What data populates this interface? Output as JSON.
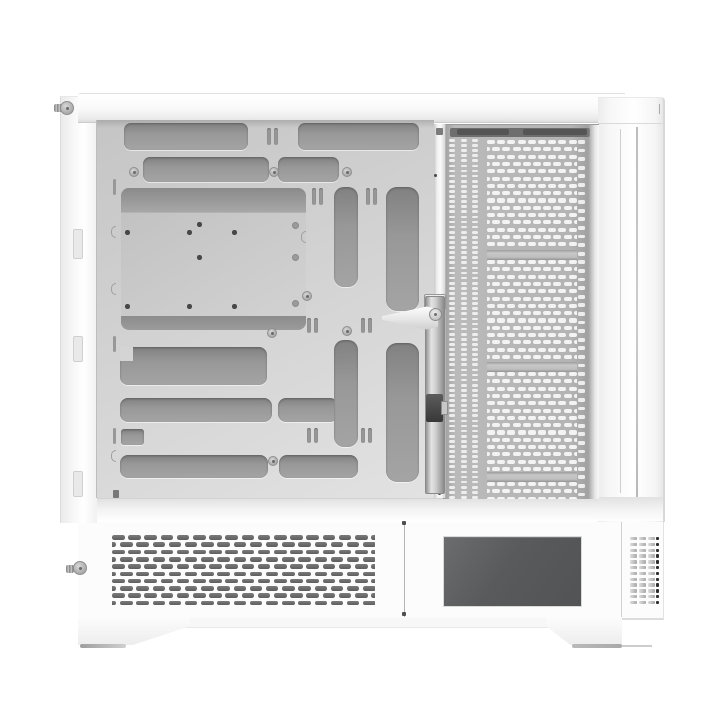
{
  "scene": {
    "subject": "white-pc-case-side-open-view",
    "background": "#ffffff"
  },
  "colors": {
    "chassis_white": "#fafafa",
    "top_panel_shade": "#dddddd",
    "tray_gray": "#d0d0d0",
    "cutout_dark": "#8e8e8e",
    "mobo_plate_gray": "#c9c9c9",
    "mesh_panel_gray": "#b4b4b4",
    "mesh_hole_white": "#f3f3f3",
    "bottom_vent_slot_dark": "#646464",
    "psu_window_gray": "#58595b",
    "right_vent_dark": "#2e2e2e",
    "foot_shadow_gray": "#a0a0a0",
    "rail_metal_gray": "#c0c0c0",
    "clamp_dark_gray": "#3f3f3f"
  },
  "patterns": {
    "front_mesh": {
      "slot_w": 8,
      "slot_h": 4.2,
      "pitch_x": 10.2,
      "pitch_y": 7.3,
      "offset": 5.1
    },
    "front_strips": {
      "slot_w": 6,
      "slot_h": 2.8,
      "pitch_y": 5.1
    },
    "front_right_column": {
      "slot_w": 6.5,
      "slot_h": 3.8,
      "pitch_y": 8.6
    },
    "bottom_vent": {
      "slot_w": 12.5,
      "slot_h": 4.7,
      "pitch_x": 16.2,
      "pitch_y": 7.3,
      "offset": 8.1,
      "rows": 10
    },
    "side_vent": {
      "rows": 12,
      "cols": 3,
      "slot_w": 6.8,
      "slot_h": 3.4,
      "pitch_x": 9.2,
      "pitch_y": 5.8,
      "dark_w": 3.4
    }
  }
}
